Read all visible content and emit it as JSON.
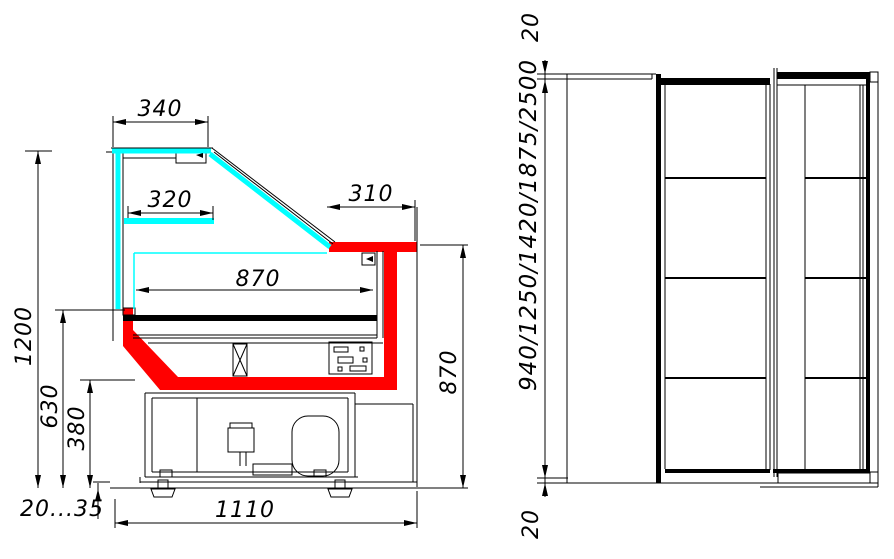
{
  "drawing": {
    "type": "refrigerated display case technical drawing",
    "colors": {
      "glass": "#00ffff",
      "highlight": "#ff0000",
      "line": "#000000",
      "background": "#ffffff"
    },
    "section_view": {
      "dim_canopy_width": "340",
      "dim_shelf_width": "320",
      "dim_worktop_depth": "310",
      "dim_display_width": "870",
      "dim_total_height": "1200",
      "dim_glass_bottom_height": "630",
      "dim_basin_height": "380",
      "dim_worktop_height": "870",
      "dim_foot_adjust": "20...35",
      "dim_total_depth": "1110"
    },
    "front_view": {
      "dim_top_overhang": "20",
      "dim_length_options": "940/1250/1420/1875/2500",
      "dim_bottom_overhang": "20"
    }
  }
}
